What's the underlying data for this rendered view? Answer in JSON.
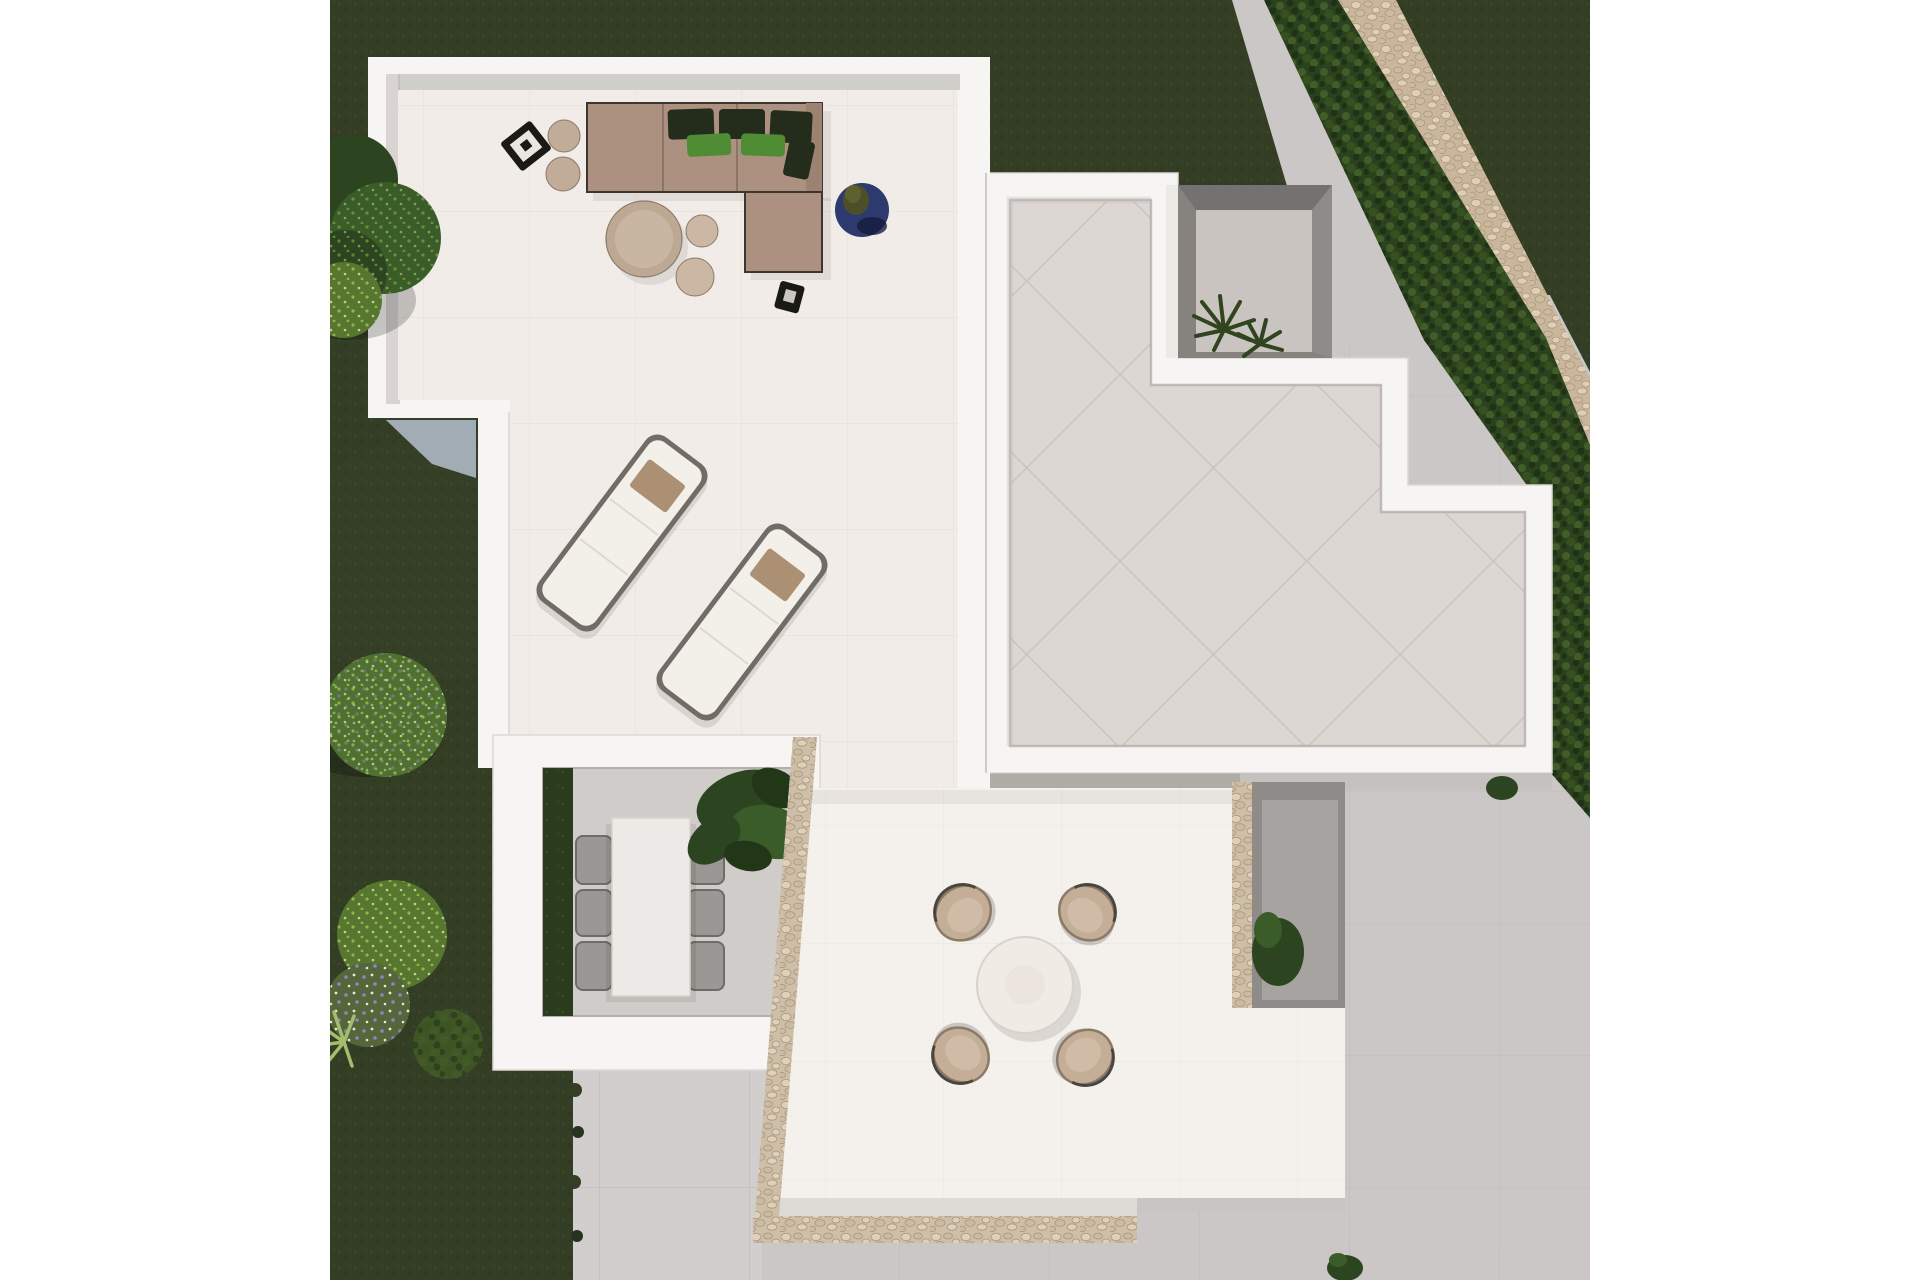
{
  "meta": {
    "type": "architectural-3d-render-top-view",
    "description": "Aerial top-down 3D render of a modern white villa roof terraces with outdoor furniture, sunken dining patio, large tiled roof deck, dark lawn garden with bushes, diagonal hedge with stone path, and light concrete pavement"
  },
  "canvas": {
    "width": 1920,
    "height": 1280,
    "content_left": 330,
    "content_right": 1590
  },
  "colors": {
    "page_bg": "#ffffff",
    "grass_base": "#333e25",
    "grass_speck1": "#46552e",
    "grass_speck2": "#273220",
    "grass_light": "#4d5d35",
    "hedge_base": "#2c421e",
    "hedge_hi": "#43612a",
    "hedge_hi2": "#37521f",
    "hedge_lo": "#1e3015",
    "path_base": "#c9b69c",
    "peb_light": "#e0d2b8",
    "peb_mid": "#cdbb9e",
    "peb_dark": "#a8937a",
    "pavement": "#cbc7c6",
    "pavement2": "#d2cecd",
    "pave_line": "#bab6b5",
    "parapet": "#f7f5f3",
    "parapet_edge": "#dcd8d5",
    "wall_shadow": "#b3aeab",
    "under_roof_shadow": "#c3bfbc",
    "glass": "#a9b2bc",
    "floor_a": "#f1ece8",
    "grid_a": "#e4dfda",
    "floor_c": "#f4f1ed",
    "grid_c": "#e9e4df",
    "roof_tile": "#dcd7d3",
    "roof_line": "#c5bfba",
    "courtyard_wall": "#86827e",
    "courtyard_wall_dark": "#757170",
    "courtyard_floor": "#c9c4c0",
    "courtyard_cope": "#eceae7",
    "lightwell_wall": "#8f8b88",
    "lightwell_floor": "#a7a3a0",
    "stone_base": "#cdbfa9",
    "patio_floor": "#d0ccc9",
    "patio_table": "#eceae7",
    "chair_gray": "#9b9795",
    "chair_gray_dark": "#6e6b68",
    "bed_green": "#2a3c1d",
    "plant_dark": "#2c4520",
    "plant_mid": "#3a5c28",
    "plant_deep": "#223618",
    "plant_palm": "#31441f",
    "sofa": "#ac9180",
    "sofa_dark": "#9d8271",
    "sofa_frame": "#3e362e",
    "cushion_dark": "#242c1c",
    "cushion_green": "#4f8c33",
    "pouf": "#c1ac9a",
    "pouf2": "#cbb7a4",
    "table_taupe": "#bca893",
    "table_taupe_in": "#c9b6a2",
    "navy": "#2d3a6e",
    "navy_dark": "#151c3d",
    "black_item": "#1b1915",
    "cloth": "#e9e5e0",
    "lounger_frame": "#716c66",
    "lounger": "#f3f0ea",
    "lounger_pillow": "#ab9074",
    "table_white": "#f0ebe5",
    "table_white_edge": "#d9d2c9",
    "chair_tan": "#c4ae97",
    "chair_tan_in": "#cfbba6",
    "chair_rim": "#8a7a66",
    "bush_bright": "#57762f",
    "bush_olive": "#3f5526",
    "bush_purple_base": "#55663a",
    "purple_dot": "#9186cc",
    "yucca": "#a3bd6d",
    "flower_white": "#eef0e2",
    "leaf_dot1": "#9cc04f",
    "leaf_dot2": "#d3e397"
  },
  "scene": {
    "items": [
      {
        "name": "upper-lounge-terrace",
        "category": "terrace",
        "note": "white parapet, cream tiled floor"
      },
      {
        "name": "l-shaped-outdoor-sofa",
        "category": "furniture",
        "note": "taupe modules, dark and green cushions"
      },
      {
        "name": "round-coffee-table-and-poufs",
        "category": "furniture"
      },
      {
        "name": "navy-round-mat-with-plant",
        "category": "decor"
      },
      {
        "name": "black-lantern-side-tables",
        "category": "decor",
        "count": 2
      },
      {
        "name": "sun-loungers",
        "category": "furniture",
        "count": 2,
        "note": "white cushions, tan pillows, tilted 37deg"
      },
      {
        "name": "sunken-dining-patio",
        "category": "patio",
        "note": "white frame, six gray chairs, white table, planting bed, monstera plant"
      },
      {
        "name": "stone-trimmed-terrace",
        "category": "terrace",
        "note": "round white table with four tan tub chairs, travertine pebble wall border"
      },
      {
        "name": "large-tiled-roof-deck",
        "category": "roof",
        "note": "diagonal tile joints, stepped white parapet, recessed courtyard with palm"
      },
      {
        "name": "right-lightwell-courtyard",
        "category": "patio",
        "note": "gray floor with plant"
      },
      {
        "name": "garden-lawn",
        "category": "landscape",
        "note": "dark green grass"
      },
      {
        "name": "diagonal-hedge-with-stone-path",
        "category": "landscape"
      },
      {
        "name": "garden-bushes",
        "category": "landscape",
        "note": "tree, round topiary, bright bushes, purple flowers, yucca"
      },
      {
        "name": "concrete-pavement",
        "category": "landscape",
        "note": "light gray slabs bottom and right"
      }
    ]
  }
}
